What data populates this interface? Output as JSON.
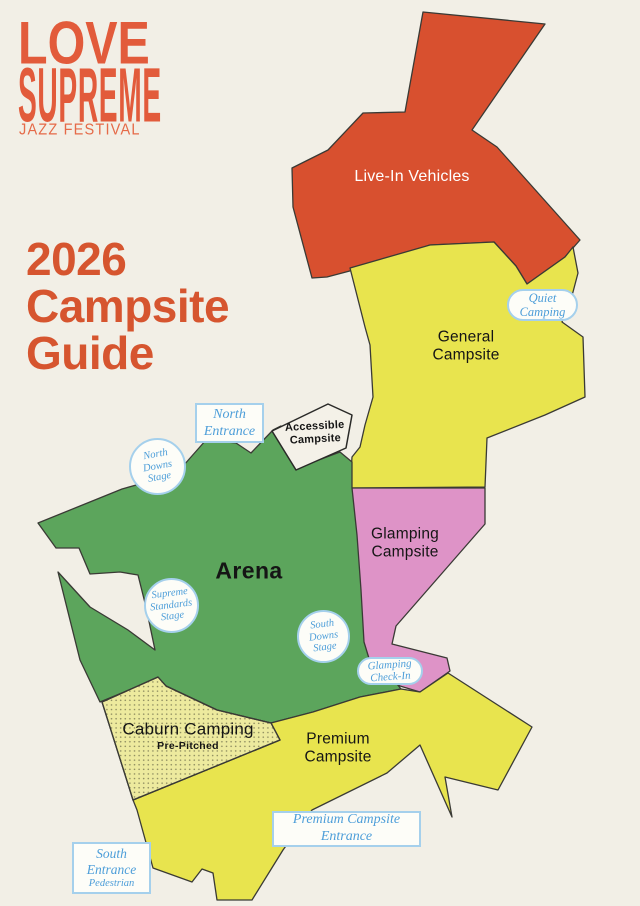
{
  "background_color": "#F2EFE6",
  "logo": {
    "word1": "LOVE",
    "word2": "SUPREME",
    "tagline": "JAZZ FESTIVAL",
    "color": "#E25B3B"
  },
  "title": {
    "text": "2026\nCampsite\nGuide",
    "color": "#D6552F"
  },
  "map": {
    "outline_color": "#3A3A35",
    "regions": {
      "live_in_vehicles": {
        "label": "Live-In Vehicles",
        "fill": "#D8502F",
        "label_color": "#FFFFFF"
      },
      "general_campsite": {
        "label": "General\nCampsite",
        "fill": "#E8E44E",
        "label_color": "#151515"
      },
      "glamping_campsite": {
        "label": "Glamping\nCampsite",
        "fill": "#DE93C7",
        "label_color": "#151515"
      },
      "arena": {
        "label": "Arena",
        "fill": "#5CA55C",
        "label_color": "#151515"
      },
      "caburn_camping": {
        "label": "Caburn Camping",
        "sublabel": "Pre-Pitched",
        "fill": "#EDEA9E",
        "dot_color": "#3E3E2B",
        "label_color": "#151515"
      },
      "premium_campsite": {
        "label": "Premium\nCampsite",
        "fill": "#E8E44E",
        "label_color": "#151515"
      },
      "accessible_campsite": {
        "label": "Accessible\nCampsite",
        "fill": "#F4F1E8",
        "label_color": "#151515"
      }
    },
    "badges": {
      "north_entrance": {
        "label": "North\nEntrance"
      },
      "quiet_camping": {
        "label": "Quiet\nCamping"
      },
      "north_downs_stage": {
        "label": "North\nDowns\nStage"
      },
      "supreme_standards_stage": {
        "label": "Supreme\nStandards\nStage"
      },
      "south_downs_stage": {
        "label": "South\nDowns\nStage"
      },
      "glamping_check_in": {
        "label": "Glamping\nCheck-In"
      },
      "premium_campsite_entrance": {
        "label": "Premium Campsite\nEntrance"
      },
      "south_entrance": {
        "label": "South\nEntrance",
        "sublabel": "Pedestrian"
      }
    },
    "badge_style": {
      "text_color": "#4D9ED9",
      "border_color": "#A5D0EC",
      "bg_color": "#FDFDF8"
    }
  }
}
